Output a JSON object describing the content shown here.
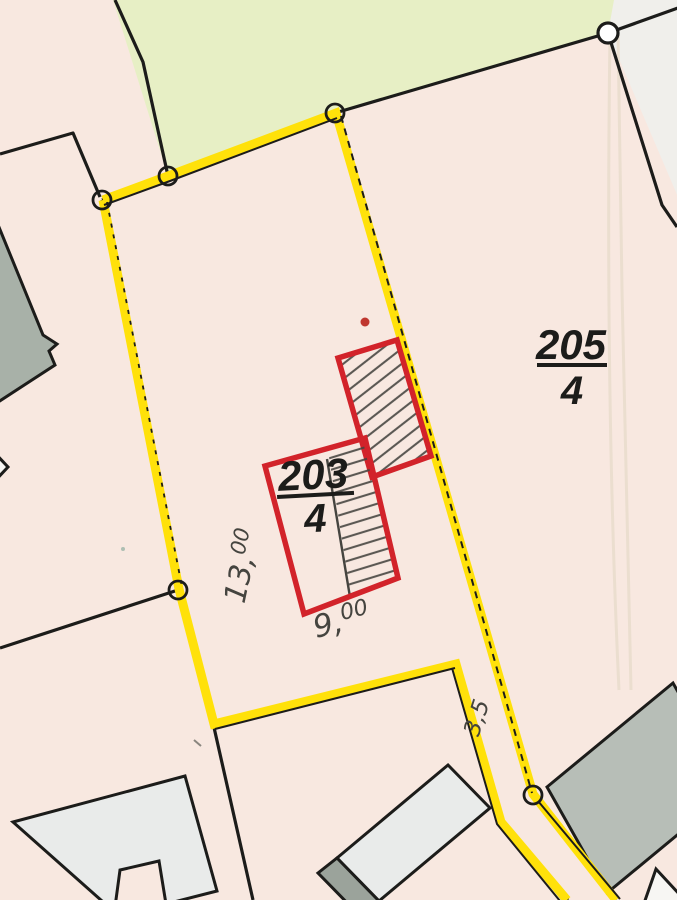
{
  "map_type": "cadastral parcel map (scanned extract)",
  "parcels": {
    "neighbor": {
      "number": "205",
      "denominator": "4"
    },
    "highlighted": {
      "number": "203",
      "denominator": "4"
    }
  },
  "measurements": {
    "west": {
      "main": "13,",
      "sup": "00"
    },
    "south": {
      "main": "9,",
      "sup": "00"
    },
    "corridor": {
      "main": "3,5"
    }
  },
  "colors": {
    "paper": "#f8e8e0",
    "meadow": "#e7efc5",
    "neighbor_parcel": "#f0efeb",
    "boundary_highlight": "#ffe10a",
    "new_building_outline": "#d2232a",
    "boundary_line": "#1c1c1a",
    "pencil": "#45443f",
    "building_light": "#e9ebea",
    "building_gray_green": "#a8b1a8",
    "building_dark": "#b7beb7",
    "red_dot": "#bf372f"
  }
}
